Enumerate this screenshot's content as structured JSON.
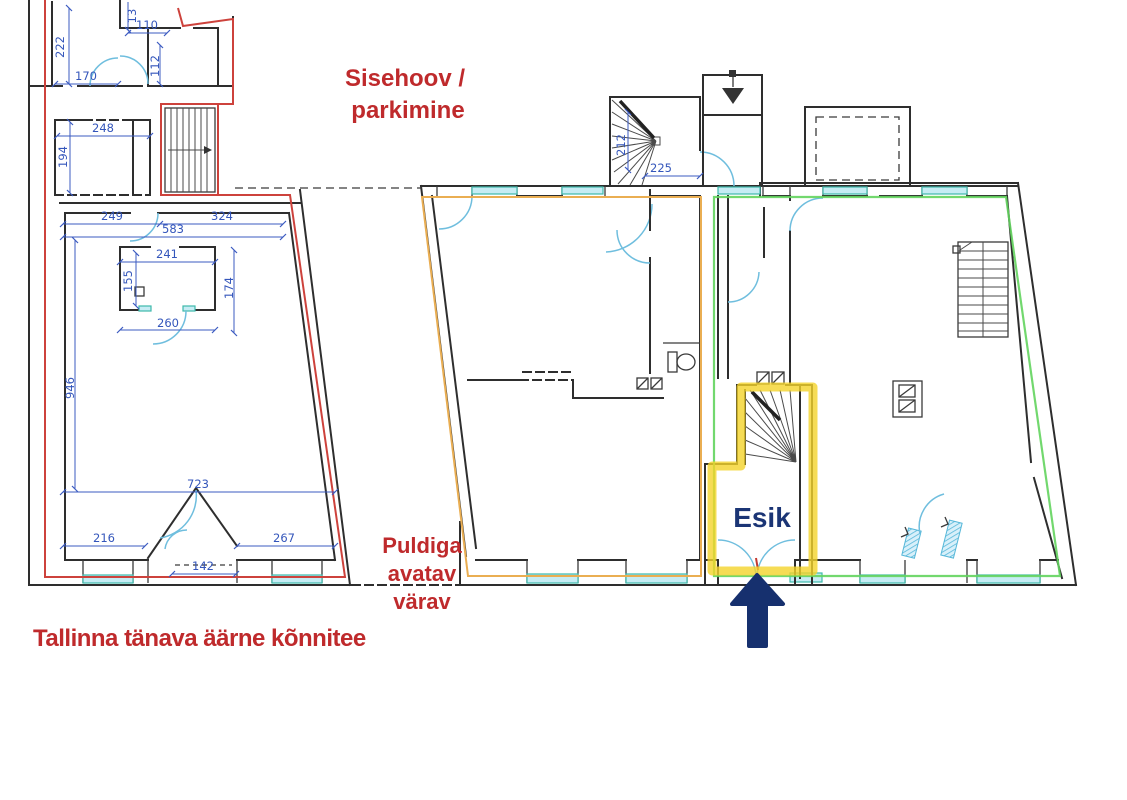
{
  "plan": {
    "type": "floor-plan",
    "labels": {
      "courtyard_line1": "Sisehoov /",
      "courtyard_line2": "parkimine",
      "gate_line1": "Puldiga",
      "gate_line2": "avatav",
      "gate_line3": "värav",
      "sidewalk": "Tallinna tänava äärne kõnnitee",
      "entrance_room": "Esik"
    },
    "dimensions": {
      "d222": "222",
      "d13": "13",
      "d110": "110",
      "d112": "112",
      "d170": "170",
      "d248": "248",
      "d194": "194",
      "d249": "249",
      "d324": "324",
      "d583": "583",
      "d241": "241",
      "d155": "155",
      "d174": "174",
      "d260": "260",
      "d946": "946",
      "d723": "723",
      "d216": "216",
      "d267": "267",
      "d142": "142",
      "d212": "212",
      "d225": "225"
    },
    "colors": {
      "annotation_red": "#bf2a2c",
      "dimension_blue": "#3456bb",
      "door_cyan": "#6fbede",
      "window_teal": "#3eb9ab",
      "navy": "#16306e",
      "boundary_red": "#cd423c",
      "boundary_orange": "#eaae52",
      "boundary_green": "#63d45e",
      "highlight_yellow": "#f4d32b",
      "wall_black": "#2e2e2e"
    }
  }
}
